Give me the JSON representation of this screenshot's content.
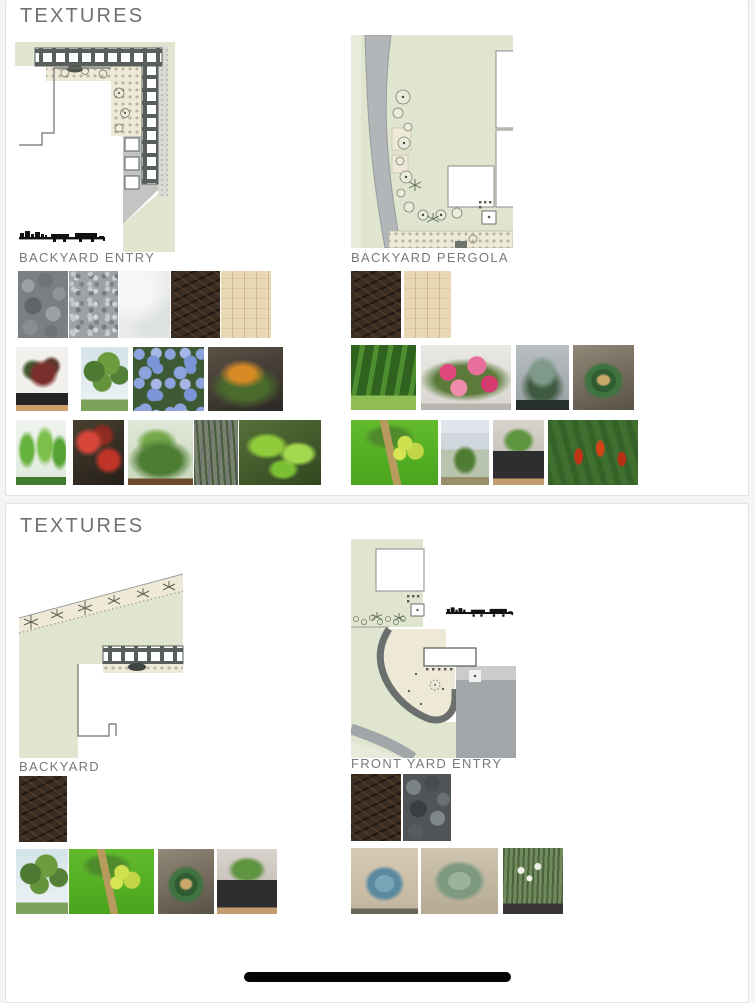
{
  "panels": [
    {
      "title": "TEXTURES",
      "sections": [
        {
          "label": "BACKYARD ENTRY",
          "plan_name": "backyard-entry-plan",
          "textures": [
            {
              "name": "gray-river-pebbles"
            },
            {
              "name": "gray-gravel"
            },
            {
              "name": "white-concrete"
            },
            {
              "name": "dark-brown-mulch"
            },
            {
              "name": "light-wood-decking"
            }
          ],
          "plant_rows": [
            [
              {
                "name": "red-leaf-philodendron"
              },
              {
                "name": "palm-trees-nursery"
              },
              {
                "name": "blue-plumbago"
              },
              {
                "name": "orange-bromeliads"
              }
            ],
            [
              {
                "name": "green-ti-plants"
              },
              {
                "name": "red-caladium"
              },
              {
                "name": "green-shrub-bed"
              },
              {
                "name": "purple-flax-grass"
              },
              {
                "name": "giant-leaf-plant"
              }
            ]
          ]
        },
        {
          "label": "BACKYARD PERGOLA",
          "plan_name": "backyard-pergola-plan",
          "textures": [
            {
              "name": "dark-brown-mulch"
            },
            {
              "name": "light-wood-decking"
            }
          ],
          "plant_rows": [
            [
              {
                "name": "green-hedge-rows"
              },
              {
                "name": "pink-bougainvillea"
              },
              {
                "name": "silver-fan-palm"
              },
              {
                "name": "sago-palm"
              }
            ],
            [
              {
                "name": "fruiting-palm-lawn"
              },
              {
                "name": "yard-shrub"
              },
              {
                "name": "potted-green-shrub"
              },
              {
                "name": "red-heliconia"
              }
            ]
          ]
        }
      ]
    },
    {
      "title": "TEXTURES",
      "sections": [
        {
          "label": "BACKYARD",
          "plan_name": "backyard-plan",
          "textures": [
            {
              "name": "dark-brown-mulch"
            }
          ],
          "plant_rows": [
            [
              {
                "name": "palm-trees-nursery"
              },
              {
                "name": "fruiting-palm-lawn"
              },
              {
                "name": "sago-palm"
              },
              {
                "name": "potted-green-shrub"
              }
            ]
          ]
        },
        {
          "label": "FRONT YARD ENTRY",
          "plan_name": "front-yard-entry-plan",
          "textures": [
            {
              "name": "dark-brown-mulch"
            },
            {
              "name": "black-river-pebbles"
            }
          ],
          "plant_rows": [
            [
              {
                "name": "blue-agave"
              },
              {
                "name": "agave-attenuata"
              },
              {
                "name": "white-iris-grass"
              }
            ]
          ]
        }
      ]
    }
  ],
  "colors": {
    "plan_lawn_green": "#dfe5cf",
    "plan_planting_cream": "#efe9d8",
    "plan_structure_dark": "#585e5c",
    "plan_road_gray": "#b3b6b8",
    "heading_gray": "#6d7174"
  },
  "home_indicator": {
    "present": true
  }
}
